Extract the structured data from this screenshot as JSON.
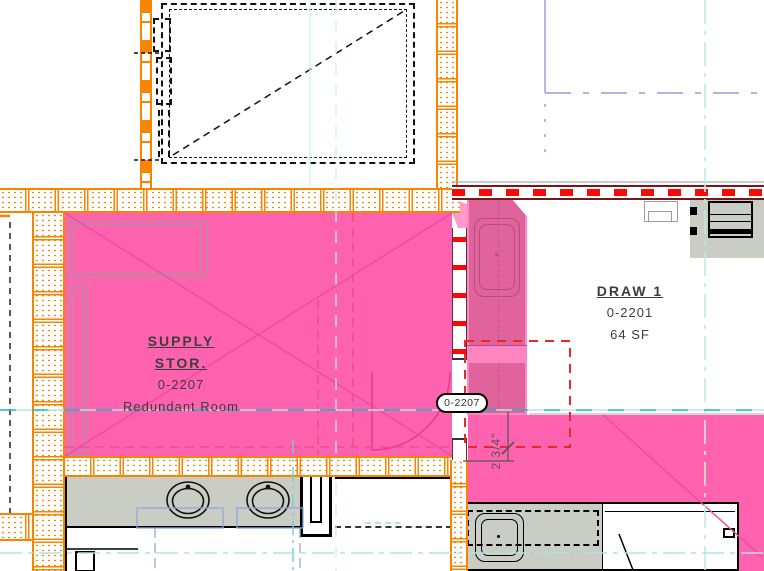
{
  "view": {
    "type": "architectural-floor-plan"
  },
  "rooms": {
    "supply_storage": {
      "name_line1": "SUPPLY",
      "name_line2": "STOR.",
      "number": "0-2207",
      "description": "Redundant Room",
      "highlight_color": "#ff62af"
    },
    "draw_1": {
      "name": "DRAW 1",
      "number": "0-2201",
      "area": "64 SF"
    },
    "chase": {
      "highlight_color": "#e0639b"
    }
  },
  "tags": {
    "door_tag": "0-2207"
  },
  "dimensions": {
    "offset": "2 3/4\""
  },
  "colors": {
    "room_highlight": "#ff62af",
    "room_highlight_dark": "#e0639b",
    "room_marker_pink": "#f248a4",
    "wall_orange": "#f88400",
    "fire_red": "#fb0907",
    "fire_dark_red": "#7c1518",
    "grid_teal": "#19bcc0",
    "underlay_lavender": "#9a9ade",
    "clearance_blue": "#92a7dd",
    "casework_gray": "#c9cdc3"
  }
}
